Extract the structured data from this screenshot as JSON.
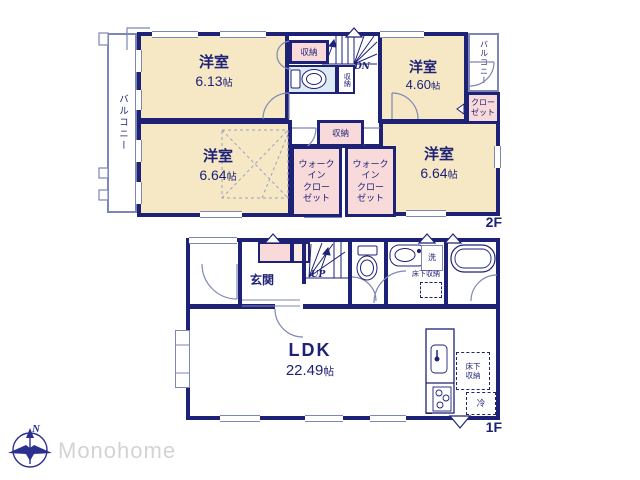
{
  "colors": {
    "wall": "#1e2277",
    "room_fill": "#f7e8c5",
    "closet_fill": "#f8dada",
    "closet_fill_light": "#fbe9e4",
    "wet_fill": "#dcebf6",
    "thin_line": "#7d87b5",
    "brand_text": "#d3d3d3"
  },
  "floor2": {
    "label": "2F",
    "balcony_left": "バルコニー",
    "balcony_right": "バルコニー",
    "room_a": {
      "name": "洋室",
      "num": "6.13",
      "unit": "帖"
    },
    "room_b": {
      "name": "洋室",
      "num": "4.60",
      "unit": "帖"
    },
    "room_c": {
      "name": "洋室",
      "num": "6.64",
      "unit": "帖"
    },
    "room_d": {
      "name": "洋室",
      "num": "6.64",
      "unit": "帖"
    },
    "storage_top": "収納",
    "storage_side": "収納",
    "storage_mid": "収納",
    "closet": "クロー\nゼット",
    "wic": "ウォーク\nイン\nクロー\nゼット",
    "stairs_down": "DN"
  },
  "floor1": {
    "label": "1F",
    "entrance": "玄関",
    "stairs_up": "UP",
    "ldk": {
      "name": "LDK",
      "num": "22.49",
      "unit": "帖"
    },
    "laundry": "洗",
    "underfloor_storage": "床下収納",
    "underfloor_storage_ldk": "床下\n収納",
    "fridge": "冷"
  },
  "logo": {
    "brand": "Monohome",
    "north": "N"
  }
}
